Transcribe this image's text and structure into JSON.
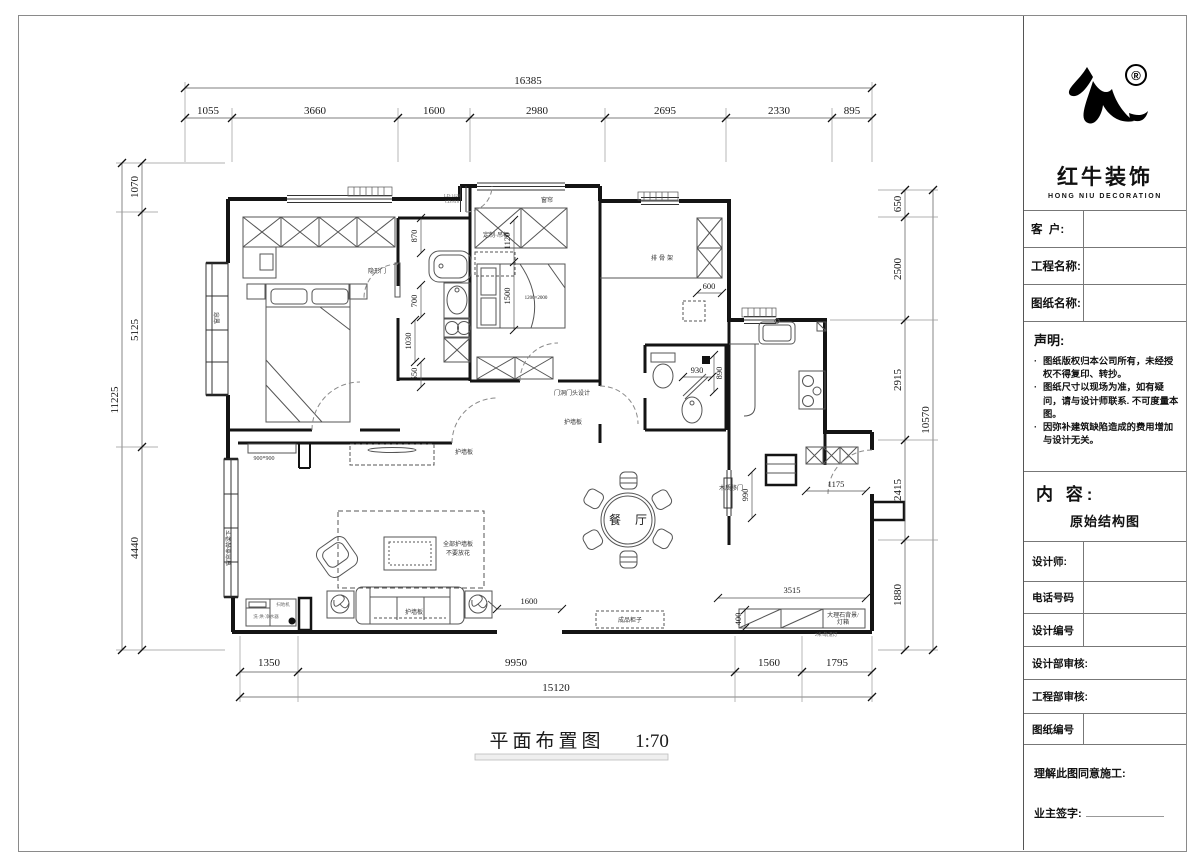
{
  "titleblock": {
    "brand_cn": "红牛装饰",
    "brand_en": "HONG NIU DECORATION",
    "reg_mark": "®",
    "field_customer": "客  户:",
    "field_project": "工程名称:",
    "field_drawing": "图纸名称:",
    "statement_title": "声明:",
    "bullet": "·",
    "statement_1": "图纸版权归本公司所有，未经授权不得复印、转抄。",
    "statement_2": "图纸尺寸以现场为准，如有疑问，请与设计师联系. 不可度量本图。",
    "statement_3": "因弥补建筑缺陷造成的费用增加与设计无关。",
    "content_label": "内 容:",
    "content_value": "原始结构图",
    "row_designer": "设计师:",
    "row_phone": "电话号码",
    "row_design_no": "设计编号",
    "row_design_audit": "设计部审核:",
    "row_eng_audit": "工程部审核:",
    "row_sheet_no": "图纸编号",
    "footer_agree": "理解此图同意施工:",
    "footer_sign": "业主签字:"
  },
  "caption": {
    "title": "平面布置图",
    "scale": "1:70"
  },
  "dims": {
    "top_total": "16385",
    "top": [
      "1055",
      "3660",
      "1600",
      "2980",
      "2695",
      "2330",
      "895"
    ],
    "left_total": "11225",
    "left": [
      "1070",
      "5125",
      "4440"
    ],
    "right_total": "10570",
    "right": [
      "650",
      "2500",
      "2915",
      "2415",
      "1880"
    ],
    "bottom_total": "15120",
    "bottom": [
      "1350",
      "9950",
      "1560",
      "1795"
    ],
    "d870": "870",
    "d700": "700",
    "d1030": "1030",
    "d550": "550",
    "d1120": "1120",
    "d1500": "1500",
    "d600": "600",
    "d930": "930",
    "d890": "890",
    "d1175": "1175",
    "d990": "990",
    "d400": "400",
    "d1600": "1600",
    "d3515": "3515"
  },
  "labels": {
    "master_door": "隐形门",
    "curtain_bay": "窗帘",
    "curtain_win": "窗帘",
    "ld_code": "LD:1420",
    "cd_code": "CD:810",
    "cabinet_custom": "定制·吊柜",
    "bed_size": "1200×2000",
    "slat_rack": "排骨架",
    "door_head": "门洞门头设计",
    "panel_tv": "护墙板",
    "panel_hall": "护墙板",
    "panel_sofa": "护墙板",
    "panel_note1": "全部护墙板",
    "panel_note2": "不要放花",
    "dining": "餐厅",
    "wood_slide_door": "木质移门",
    "cabinet_finished": "成品柜子",
    "marble_1": "大理石背景/",
    "marble_2": "灯箱",
    "track_light": "2米3轨道灯",
    "size900": "900*900",
    "curtain_box": "窗帘盒做梁下",
    "entry_cab1": "扫地机",
    "entry_cab2": "洗·烘·净水器"
  }
}
